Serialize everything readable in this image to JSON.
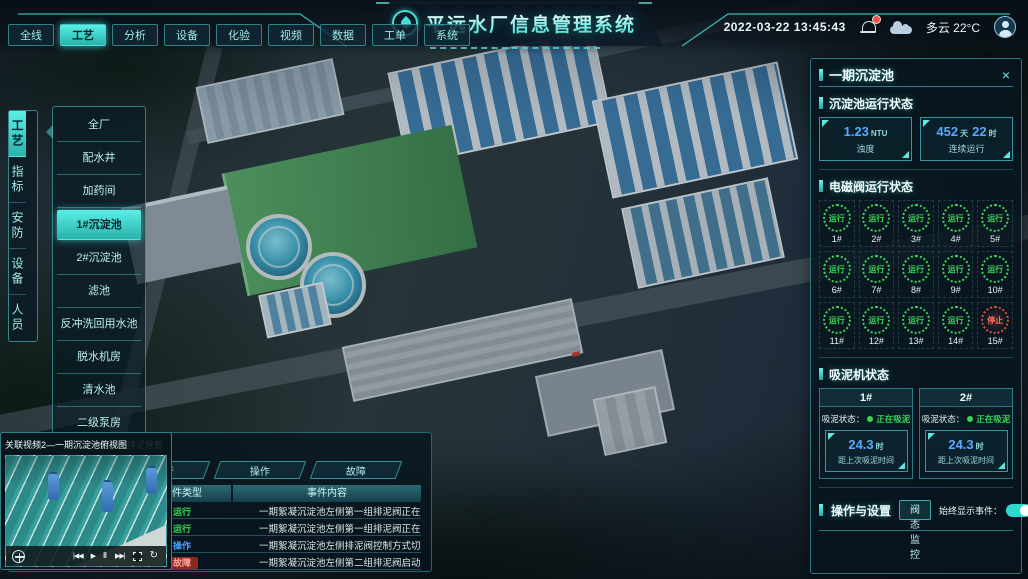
{
  "header": {
    "nav_tabs": [
      {
        "label": "全线",
        "active": false
      },
      {
        "label": "工艺",
        "active": true
      },
      {
        "label": "分析",
        "active": false
      },
      {
        "label": "设备",
        "active": false
      },
      {
        "label": "化验",
        "active": false
      },
      {
        "label": "视频",
        "active": false
      },
      {
        "label": "数据",
        "active": false
      },
      {
        "label": "工单",
        "active": false
      },
      {
        "label": "系统",
        "active": false
      }
    ],
    "title": "平远水厂信息管理系统",
    "datetime": "2022-03-22 13:45:43",
    "weather_label": "多云 22°C"
  },
  "sidebar": {
    "tabs": [
      {
        "label": "工艺",
        "active": true
      },
      {
        "label": "指标",
        "active": false
      },
      {
        "label": "安防",
        "active": false
      },
      {
        "label": "设备",
        "active": false
      },
      {
        "label": "人员",
        "active": false
      }
    ]
  },
  "process_menu": {
    "items": [
      {
        "label": "全厂",
        "active": false
      },
      {
        "label": "配水井",
        "active": false
      },
      {
        "label": "加药间",
        "active": false
      },
      {
        "label": "1#沉淀池",
        "active": true
      },
      {
        "label": "2#沉淀池",
        "active": false
      },
      {
        "label": "滤池",
        "active": false
      },
      {
        "label": "反冲洗回用水池",
        "active": false
      },
      {
        "label": "脱水机房",
        "active": false
      },
      {
        "label": "清水池",
        "active": false
      },
      {
        "label": "二级泵房",
        "active": false
      }
    ]
  },
  "right_panel": {
    "title": "一期沉淀池",
    "status_section": {
      "title": "沉淀池运行状态",
      "stat1": {
        "value": "1.23",
        "unit": "NTU",
        "label": "浊度"
      },
      "stat2": {
        "value1": "452",
        "unit1": "天",
        "value2": "22",
        "unit2": "时",
        "label": "连续运行"
      }
    },
    "valve_section": {
      "title": "电磁阀运行状态",
      "valves": [
        {
          "id": "1#",
          "label": "运行",
          "state": "run"
        },
        {
          "id": "2#",
          "label": "运行",
          "state": "run"
        },
        {
          "id": "3#",
          "label": "运行",
          "state": "run"
        },
        {
          "id": "4#",
          "label": "运行",
          "state": "run"
        },
        {
          "id": "5#",
          "label": "运行",
          "state": "run"
        },
        {
          "id": "6#",
          "label": "运行",
          "state": "run"
        },
        {
          "id": "7#",
          "label": "运行",
          "state": "run"
        },
        {
          "id": "8#",
          "label": "运行",
          "state": "run"
        },
        {
          "id": "9#",
          "label": "运行",
          "state": "run"
        },
        {
          "id": "10#",
          "label": "运行",
          "state": "run"
        },
        {
          "id": "11#",
          "label": "运行",
          "state": "run"
        },
        {
          "id": "12#",
          "label": "运行",
          "state": "run"
        },
        {
          "id": "13#",
          "label": "运行",
          "state": "run"
        },
        {
          "id": "14#",
          "label": "运行",
          "state": "run"
        },
        {
          "id": "15#",
          "label": "停止",
          "state": "stop"
        }
      ]
    },
    "mud_section": {
      "title": "吸泥机状态",
      "machines": [
        {
          "id": "1#",
          "status_label": "吸泥状态：",
          "status_value": "正在吸泥",
          "time_value": "24.3",
          "time_unit": "时",
          "time_label": "距上次吸泥时间"
        },
        {
          "id": "2#",
          "status_label": "吸泥状态：",
          "status_value": "正在吸泥",
          "time_value": "24.3",
          "time_unit": "时",
          "time_label": "距上次吸泥时间"
        }
      ]
    },
    "ops_section": {
      "title": "操作与设置",
      "button_label": "阀态监控",
      "toggle_label": "始终显示事件：",
      "toggle_on": true
    }
  },
  "events_panel": {
    "title": "一期沉淀池事件",
    "filter_tabs": [
      {
        "label": "全部",
        "active": true
      },
      {
        "label": "运行",
        "active": false
      },
      {
        "label": "操作",
        "active": false
      },
      {
        "label": "故障",
        "active": false
      }
    ],
    "columns": [
      {
        "label": "日期与时间"
      },
      {
        "label": "事件类型"
      },
      {
        "label": "事件内容"
      }
    ],
    "rows": [
      {
        "time": "2022/04/12 10:25:35",
        "type": "运行",
        "type_key": "run",
        "content": "一期絮凝沉淀池左侧第一组排泥阀正在排泥"
      },
      {
        "time": "2022/04/12 10:25:35",
        "type": "运行",
        "type_key": "run",
        "content": "一期絮凝沉淀池左侧第一组排泥阀正在排泥"
      },
      {
        "time": "2022/04/12 10:25:35",
        "type": "操作",
        "type_key": "op",
        "content": "一期絮凝沉淀池左侧排泥阀控制方式切换为手动"
      },
      {
        "time": "2022/04/12 10:25:35",
        "type": "故障",
        "type_key": "fault",
        "content": "一期絮凝沉淀池左侧第二组排泥阀启动失败"
      }
    ]
  },
  "videos": [
    {
      "title": "关联视频1—一期沉淀池平流区排泥管廊",
      "scene": "pumps"
    },
    {
      "title": "关联视频2—一期沉淀池俯视图",
      "scene": "tanks"
    }
  ],
  "icons": {
    "close": "×",
    "prev": "|◀◀",
    "play": "▶",
    "pause": "‖",
    "next": "▶▶|",
    "repeat": "↻"
  },
  "colors": {
    "accent": "#3fd9d4",
    "value_blue": "#59a9ff",
    "run_green": "#3bd457",
    "op_blue": "#4aa0ff",
    "fault_red": "#d8503e"
  }
}
